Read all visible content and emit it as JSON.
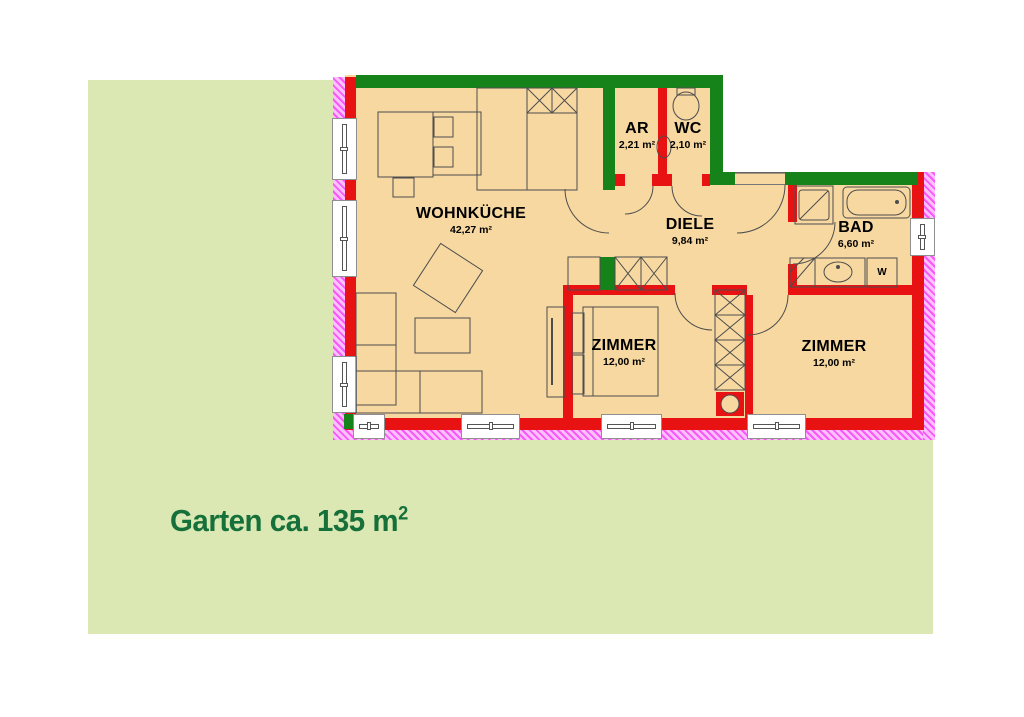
{
  "garden": {
    "label_text": "Garten ca. 135 m",
    "label_sup": "2"
  },
  "rooms": {
    "wohnkueche": {
      "name": "WOHNKÜCHE",
      "area": "42,27 m²"
    },
    "ar": {
      "name": "AR",
      "area": "2,21 m²"
    },
    "wc": {
      "name": "WC",
      "area": "2,10 m²"
    },
    "diele": {
      "name": "DIELE",
      "area": "9,84 m²"
    },
    "bad": {
      "name": "BAD",
      "area": "6,60 m²"
    },
    "zimmer_left": {
      "name": "ZIMMER",
      "area": "12,00 m²"
    },
    "zimmer_right": {
      "name": "ZIMMER",
      "area": "12,00 m²"
    }
  },
  "appliances": {
    "washing_machine": "W"
  },
  "colors": {
    "garden": "#dce8b4",
    "floor": "#f7d8a1",
    "wall_red": "#e81212",
    "wall_green": "#15821a",
    "insulation_pink": "#f858f8",
    "garden_text": "#15703a"
  }
}
